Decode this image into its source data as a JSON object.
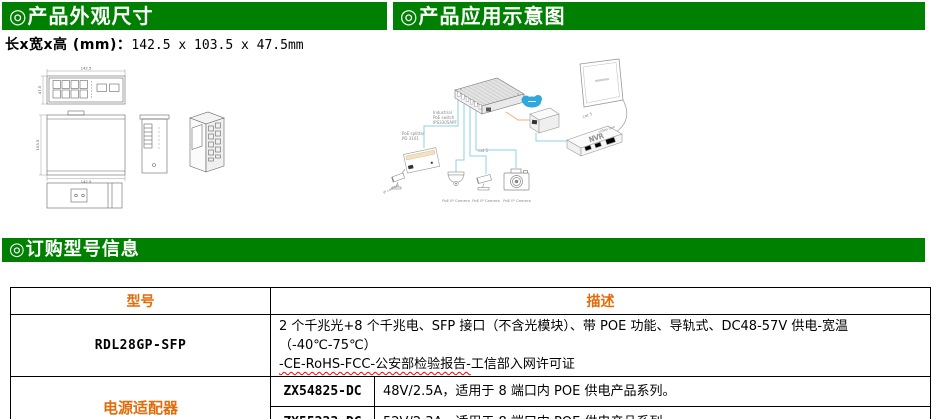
{
  "appearance": {
    "title": "◎产品外观尺寸",
    "size_label": "长x宽x高 (mm)：",
    "size_value": "142.5 x 103.5 x 47.5mm",
    "dims": {
      "width": "142.5",
      "height": "47.5",
      "depth": "103.5"
    }
  },
  "application": {
    "title": "◎产品应用示意图",
    "labels": {
      "switch_line1": "Industrial",
      "switch_line2": "PoE switch",
      "switch_line3": "IPS3305APF",
      "splitter_line1": "PoE splitter",
      "splitter_line2": "PD 3101",
      "ip_camera": "IP camera",
      "cat5": "cat 5",
      "video_line": "video line",
      "nvr": "NVR",
      "poe_camera": "PoE IP Camera"
    }
  },
  "ordering": {
    "title": "◎订购型号信息",
    "table": {
      "col_model": "型号",
      "col_desc": "描述",
      "row1": {
        "model": "RDL28GP-SFP",
        "desc_line1": "2 个千兆光+8 个千兆电、SFP 接口（不含光模块）、带 POE 功能、导轨式、DC48-57V 供电-宽温（-40℃-75℃）",
        "desc_line2_marked": "-CE-RoHS-FCC-公安部检验报告-",
        "desc_line2_rest": "工信部入网许可证"
      },
      "row2": {
        "model": "电源适配器",
        "sub1_part": "ZX54825-DC",
        "sub1_desc": "48V/2.5A，适用于 8 端口内 POE 供电产品系列。",
        "sub2_part": "ZX55223-DC",
        "sub2_desc": "52V/2.3A，适用于 8 端口内 POE 供电产品系列。"
      }
    }
  },
  "colors": {
    "header_green": "#008000",
    "accent_orange": "#E36C0A",
    "cable_blue": "#8ED0EA",
    "fiber_orange": "#F0B070",
    "cloud_blue": "#2FA8DC"
  }
}
